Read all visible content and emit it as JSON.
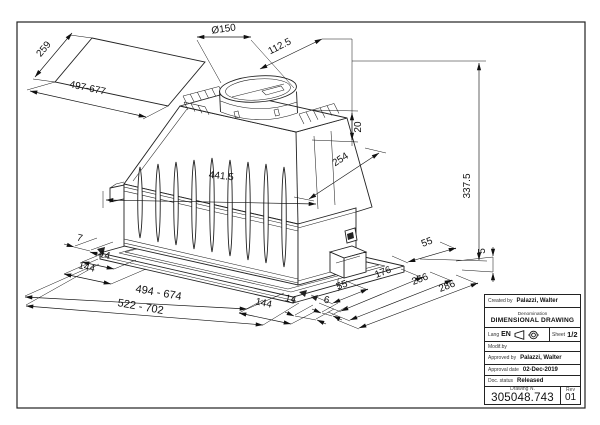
{
  "dimensions": {
    "panel_depth": "259",
    "panel_width": "497-677",
    "duct_diameter": "Ø150",
    "duct_offset": "112.5",
    "rib_height": "20",
    "top_depth": "254",
    "inner_width": "441.5",
    "total_height": "337.5",
    "left_offset_7": "7",
    "left_offset_14": "14",
    "left_offset_144": "144",
    "cutout_width": "494 - 674",
    "overall_width": "522 - 702",
    "right_offset_144": "144",
    "right_offset_14": "14",
    "right_offset_6": "6",
    "depth_55_front": "55",
    "depth_176": "176",
    "depth_256": "256",
    "depth_286": "286",
    "depth_55_rear": "55",
    "flange_height": "5"
  },
  "title_block": {
    "created_by_label": "Created by",
    "created_by": "Palazzi, Walter",
    "denomination_label": "Denomination",
    "denomination": "DIMENSIONAL DRAWING",
    "lang_label": "Lang",
    "lang_value": "EN",
    "sheet_label": "Sheet",
    "sheet_value": "1/2",
    "modified_by_label": "Modif.by",
    "approved_by_label": "Approved by",
    "approved_by": "Palazzi, Walter",
    "approval_date_label": "Approval date",
    "approval_date": "02-Dec-2019",
    "doc_status_label": "Doc. status",
    "doc_status": "Released",
    "drawing_number_label": "Drawing N.",
    "drawing_number": "305048.743",
    "rev_label": "Rev",
    "rev_value": "01"
  }
}
